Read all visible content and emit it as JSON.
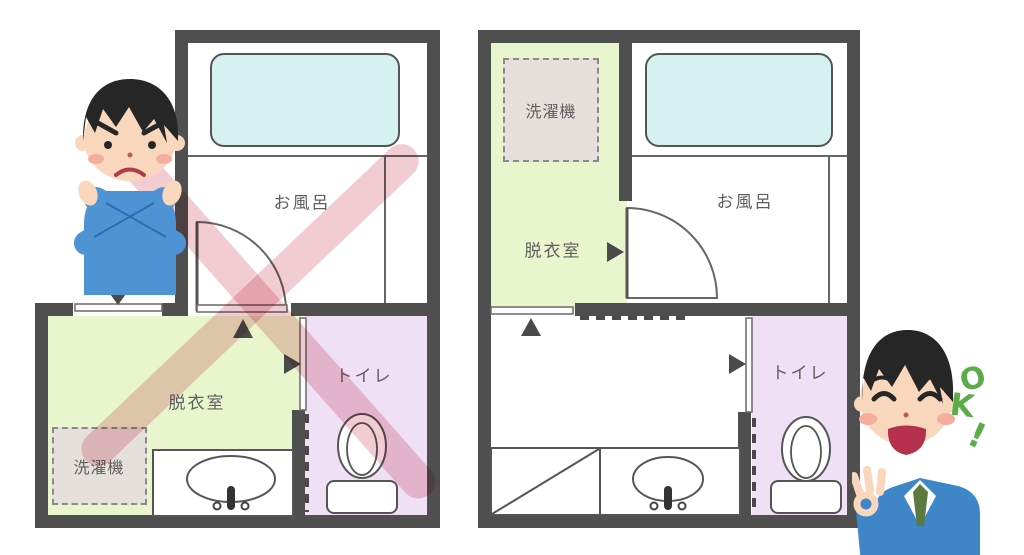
{
  "diagram": {
    "bad_plan": {
      "bath_label": "お風呂",
      "dressing_label": "脱衣室",
      "toilet_label": "トイレ",
      "washer_label": "洗濯機"
    },
    "good_plan": {
      "bath_label": "お風呂",
      "dressing_label": "脱衣室",
      "toilet_label": "トイレ",
      "washer_label": "洗濯機",
      "ok_letters": [
        "O",
        "K",
        "!"
      ]
    },
    "colors": {
      "wall": "#4f4f4f",
      "line": "#666666",
      "bathtub": "#d5f2f1",
      "dressing_room": "#e9f6cd",
      "toilet_room": "#efe0f6",
      "washer_box": "#e6e0dd",
      "cross_pink": "#f2ccd3",
      "ok_green": "#5cad4a",
      "label_text": "#5f5f5f",
      "arrow": "#4a4a4a",
      "skin": "#f9d7bc",
      "hair": "#262626",
      "figure_blue": "#4e94d4",
      "suit_blue": "#3f86c9",
      "tie_green": "#5c7a3e"
    }
  }
}
